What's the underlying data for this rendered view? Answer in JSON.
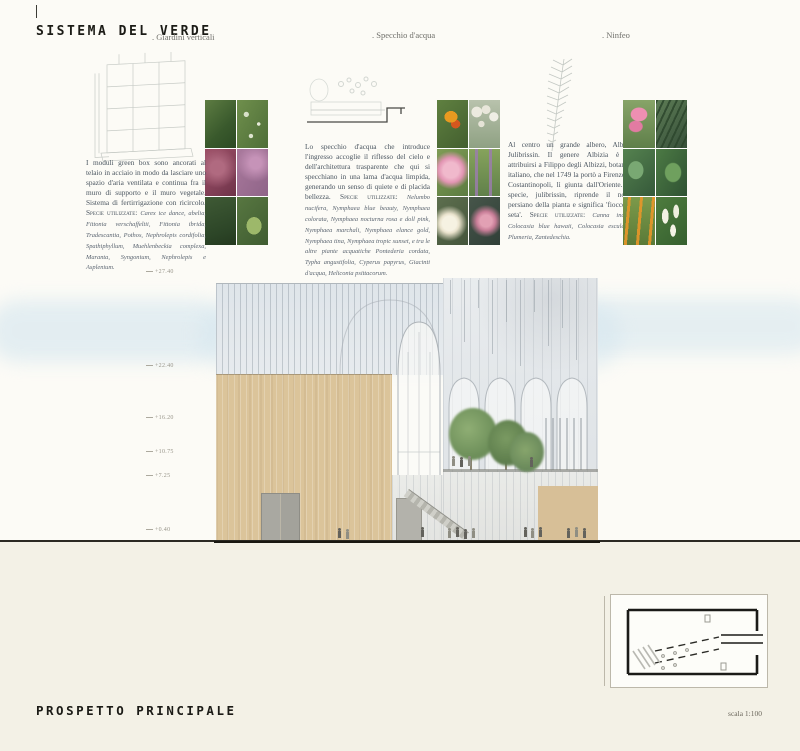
{
  "palette": {
    "paper-top": "#fcfbf6",
    "paper-bottom": "#f3f1e6",
    "ink": "#1b1b16",
    "label": "#6f6f6a",
    "text": "#49545f",
    "tan": "#dbc49a",
    "sky": "#cfe3ee"
  },
  "header": {
    "title": "SISTEMA DEL VERDE"
  },
  "sections": [
    {
      "label": ". Giardini verticali",
      "body": "I moduli green box sono ancorati al telaio in acciaio in modo da lasciare uno spazio d'aria ventilata e continua fra il muro di supporto e il muro vegetale. Sistema di fertirrigazione con ricircolo.",
      "species_label": "Specie utilizzate:",
      "species": "Carex ice dance, abelia, Fittonia verschaffeltii, Fittonia ibrida, Tradescantia, Pothos, Nephrolepis cordifolia, Spathiphyllum, Muehlenbeckia complexa, Maranta, Syngonium, Nephrolepis e Asplenium."
    },
    {
      "label": ". Specchio d'acqua",
      "body": "Lo specchio d'acqua che introduce l'ingresso accoglie il riflesso del cielo e dell'architettura trasparente che qui si specchiano in una lama d'acqua limpida, generando un senso di quiete e di placida bellezza.",
      "species_label": "Specie utilizzate:",
      "species": "Nelumbo nucifera, Nymphaea blue beauty, Nymphaea colorata, Nymphaea nocturna rosa e doll pink, Nymphaea marchali, Nymphaea elance gold, Nymphaea tina, Nymphaea tropic sunset, e tra le altre piante acquatiche Pontederia cordata, Typha angustifolia, Cyperus papyrus, Giacinti d'acqua, Heliconia psittacorum."
    },
    {
      "label": ". Ninfeo",
      "body": "Al centro un grande albero, Albizia Julibrissin. Il genere Albizia è da attribuirsi a Filippo degli Albizzi, botanico italiano, che nel 1749 la portò a Firenze da Costantinopoli, lì giunta dall'Oriente. La specie, julibrissin, riprende il nome persiano della pianta e significa 'fiocco di seta'.",
      "species_label": "Specie utilizzate:",
      "species": "Canna indica, Colocasia blue hawaii, Colocasia esculenta, Plumeria, Zantedeschia."
    }
  ],
  "elevation": {
    "levels": [
      "+27.40",
      "+22.40",
      "+16.20",
      "+10.75",
      "+7.25",
      "+0.40"
    ]
  },
  "footer": {
    "title": "PROSPETTO PRINCIPALE",
    "scale": "scala 1:100"
  }
}
